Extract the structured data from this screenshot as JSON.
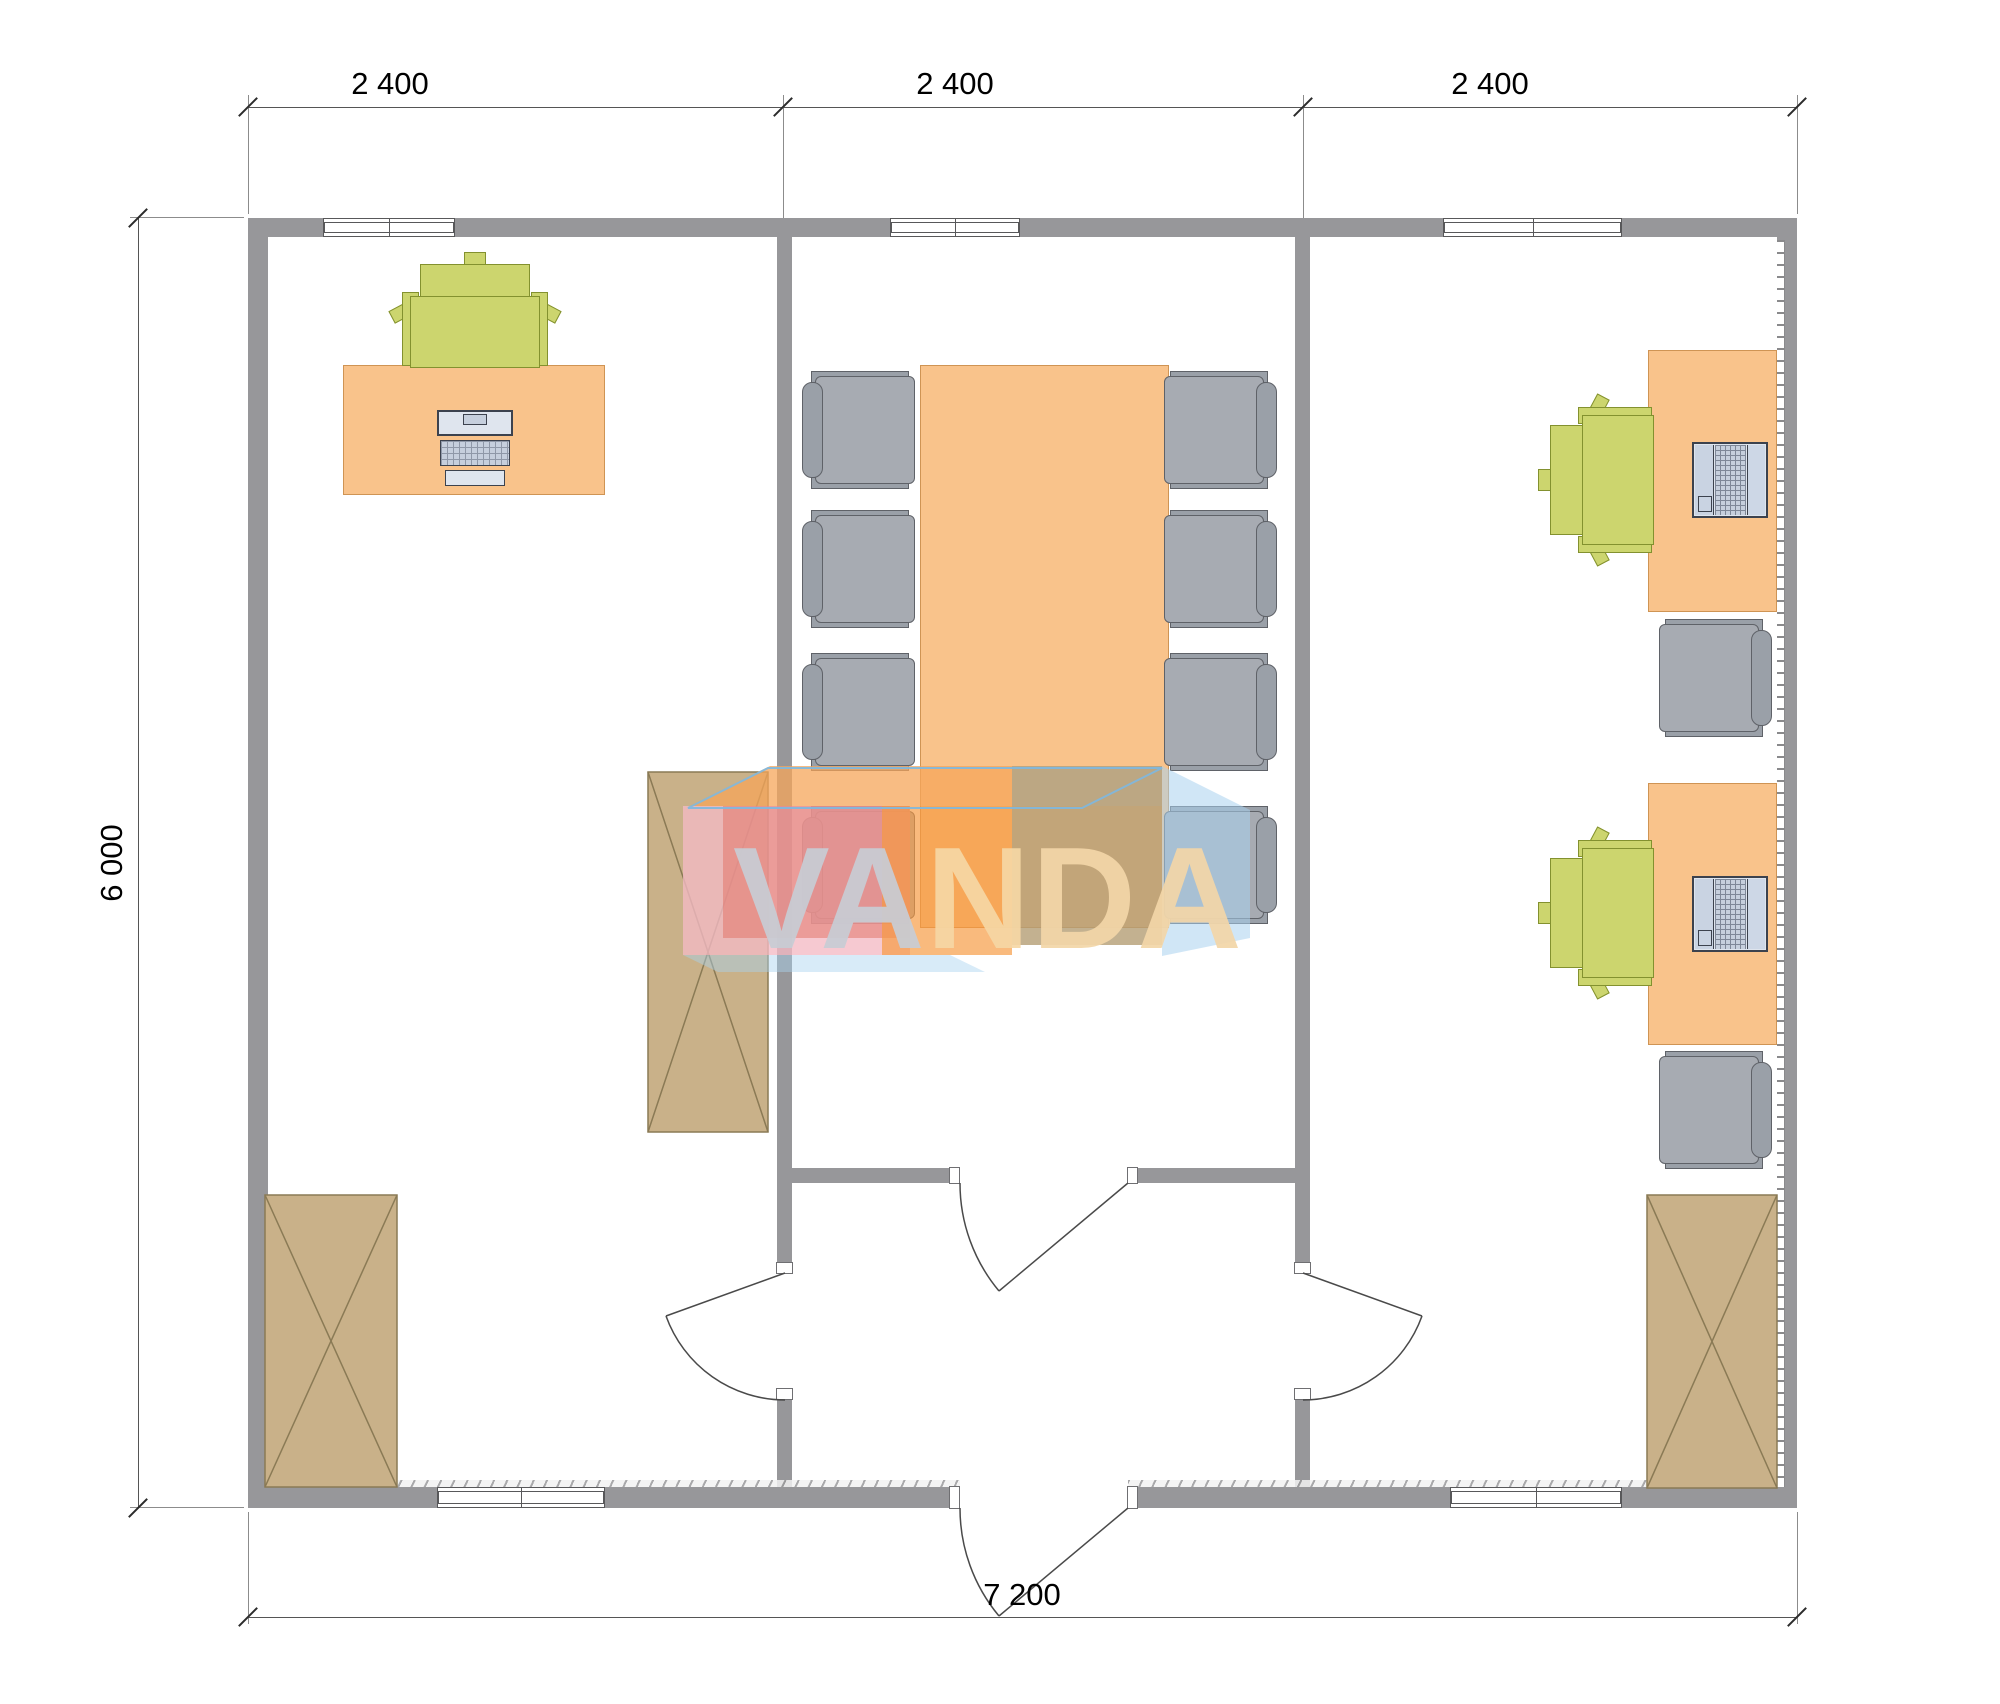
{
  "dimensions": {
    "top": [
      "2 400",
      "2 400",
      "2 400"
    ],
    "left": "6 000",
    "bottom": "7 200"
  },
  "watermark": {
    "va": "VA",
    "n": "N",
    "da": "DA",
    "full": "VANDA"
  },
  "palette": {
    "wall": "#97979a",
    "desk_fill": "#f9c38b",
    "desk_border": "#cf9454",
    "chair_gray": "#a7abb2",
    "chair_green": "#ccd56e",
    "cabinet_fill": "#c9b189",
    "cabinet_line": "#8a7a55",
    "computer_fill": "#dfe5ee",
    "watermark_pink": "#f4bac4",
    "watermark_red": "#e2766c",
    "watermark_orange": "#f6993f",
    "watermark_tan": "#b49e74",
    "watermark_blue": "#a9d2ef"
  }
}
